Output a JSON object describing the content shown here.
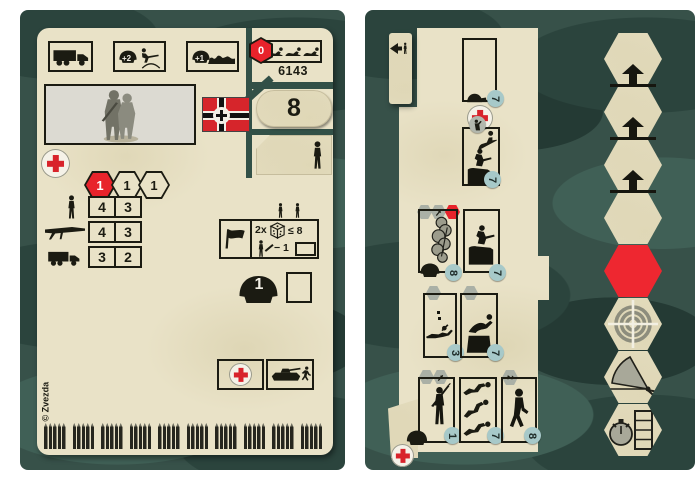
{
  "colors": {
    "camo_base": "#375149",
    "camo_dark": "#2b443d",
    "camo_darker": "#243a34",
    "camo_light": "#406056",
    "card_tan": "#e9e2c7",
    "ink": "#1b1b12",
    "red": "#e8232b",
    "flag_red": "#d6252b",
    "badge_teal": "#a7c9c9",
    "hex_gray": "#aab0a6",
    "photo_bg": "#dcdad2"
  },
  "icons": {
    "medic_cross": "+",
    "up_arrow": "▲",
    "left_arrow": "◀",
    "special_track_hexes": [
      "red-hex",
      "target-hex",
      "fire-arc-hex",
      "stopwatch-hex"
    ]
  },
  "left_card": {
    "catalog_number": "6143",
    "strength_value": "8",
    "top_row": {
      "reinforce_label": "+2",
      "repair_label": "+1",
      "casualty_value": "0"
    },
    "movement_hexes": [
      "1",
      "1",
      "1"
    ],
    "stats_table": {
      "rows": [
        {
          "icon": "infantry",
          "move": "4",
          "fire": "3"
        },
        {
          "icon": "machine-gun",
          "move": "4",
          "fire": "3"
        },
        {
          "icon": "truck",
          "move": "3",
          "fire": "2"
        }
      ]
    },
    "command_box": {
      "multiplier": "2x",
      "dice_check": "≤ 8",
      "penalty": "− 1"
    },
    "helmet_value": "1",
    "copyright": "© Zvezda",
    "ammo": {
      "groups": 10,
      "bullets_per_group": 5
    }
  },
  "right_card": {
    "action_boxes": [
      {
        "name": "heal",
        "badge": "7"
      },
      {
        "name": "assault-climb",
        "badge": "7"
      },
      {
        "name": "smoke-screen",
        "badge": "8"
      },
      {
        "name": "fire-from-cover",
        "badge": "7"
      },
      {
        "name": "prone-fire",
        "badge": "3"
      },
      {
        "name": "vault-obstacle",
        "badge": "7"
      },
      {
        "name": "melee-assault",
        "badge": "1"
      },
      {
        "name": "take-casualties",
        "badge": "7"
      },
      {
        "name": "march",
        "badge": "8"
      }
    ],
    "march_hex_value": "2",
    "track": {
      "plain_hex_count": 4,
      "arrow_count": 3
    }
  }
}
